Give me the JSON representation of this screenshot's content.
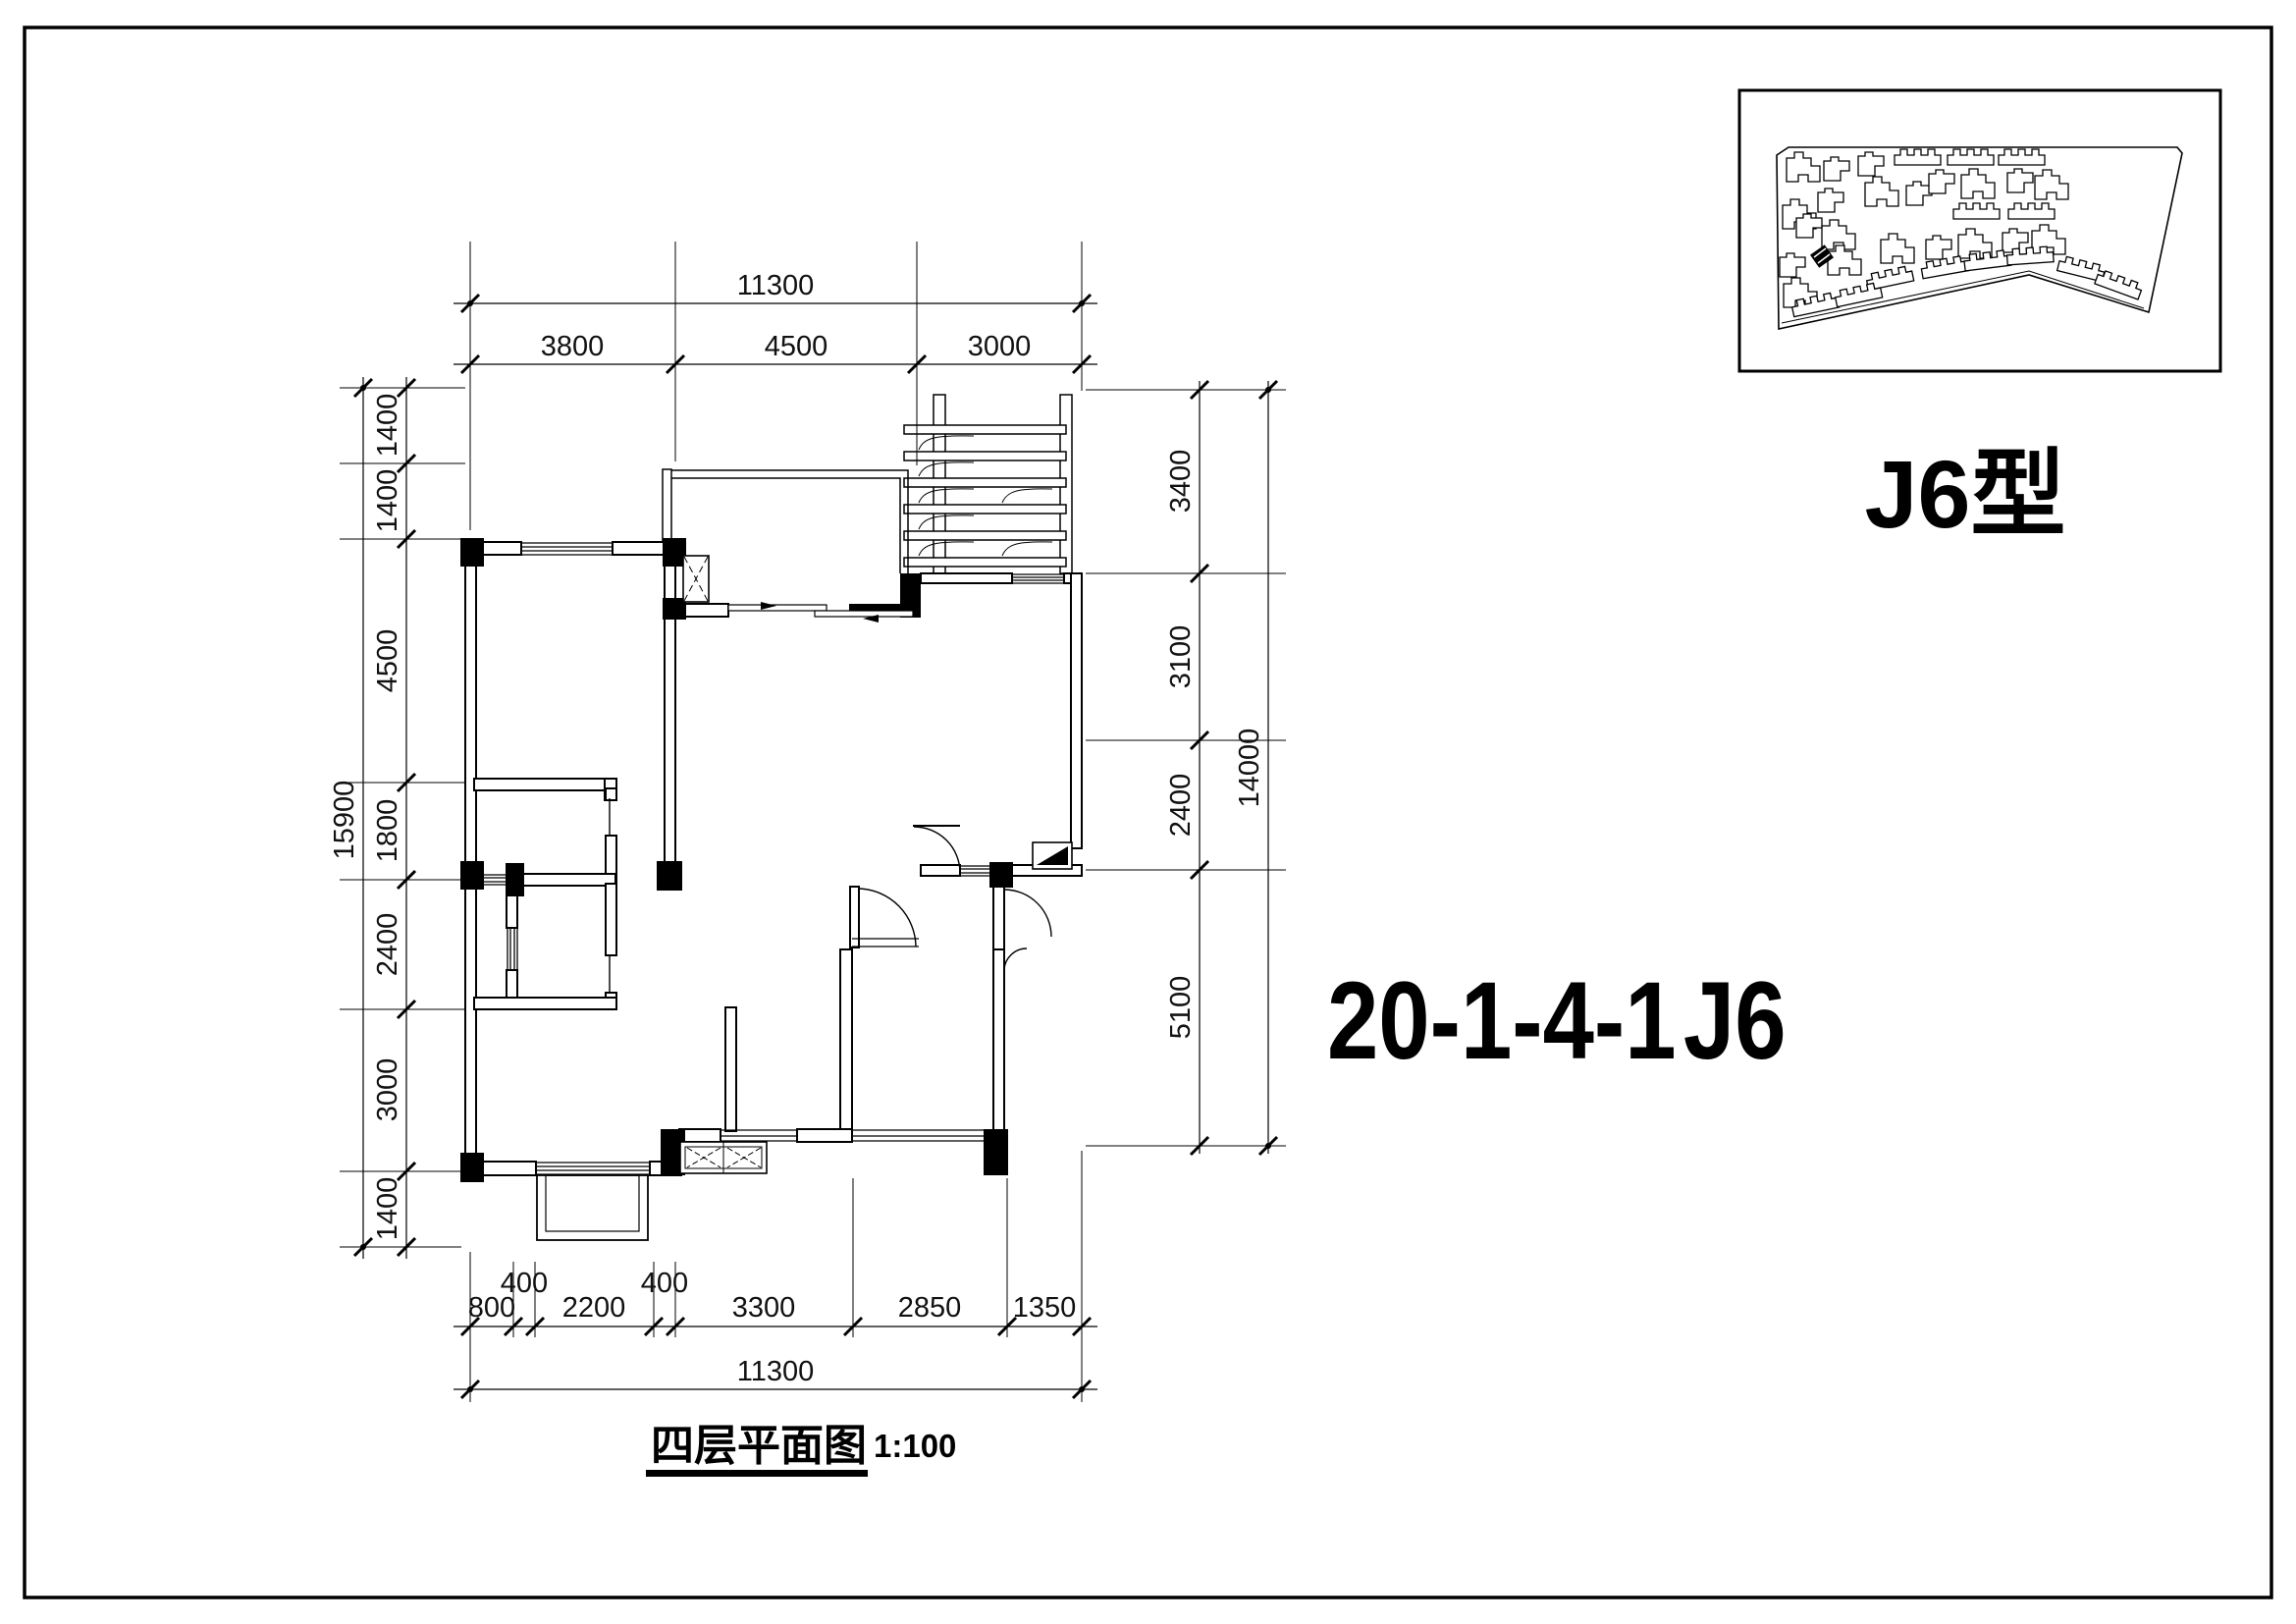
{
  "titles": {
    "plan_type": "J6型",
    "unit_code": "20-1-4-1",
    "unit_type": "J6",
    "caption": "四层平面图",
    "scale": "1:100"
  },
  "dimensions": {
    "top": {
      "total": "11300",
      "segments": [
        "3800",
        "4500",
        "3000"
      ]
    },
    "left": {
      "total": "15900",
      "segments": [
        "1400",
        "1400",
        "4500",
        "1800",
        "2400",
        "3000",
        "1400"
      ]
    },
    "right": {
      "total": "14000",
      "segments": [
        "3400",
        "3100",
        "2400",
        "5100"
      ]
    },
    "bottom": {
      "total": "11300",
      "segments": [
        "800",
        "400",
        "2200",
        "400",
        "3300",
        "2850",
        "1350"
      ]
    }
  },
  "colors": {
    "ink": "#000000",
    "paper": "#ffffff"
  }
}
